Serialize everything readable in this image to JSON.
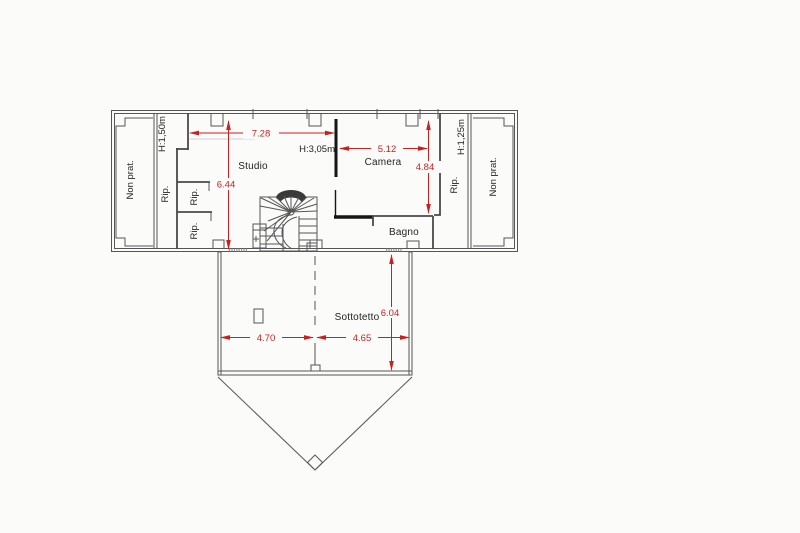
{
  "canvas": {
    "background": "#fbfbfa",
    "wall_color": "#565656",
    "dark_wall_color": "#161616",
    "dimension_color": "#cd1e1e",
    "text_color": "#232323"
  },
  "floor_plan": {
    "rooms": {
      "non_prat_left": {
        "label": "Non prat."
      },
      "storage_strip_left": {
        "label": "Rip.",
        "height_label": "H:1,50m"
      },
      "storage_upper": {
        "label": "Rip."
      },
      "storage_lower": {
        "label": "Rip."
      },
      "studio": {
        "label": "Studio",
        "width": "7.28",
        "depth": "6.44"
      },
      "camera": {
        "label": "Camera",
        "height_label": "H:3,05m",
        "width": "5.12",
        "depth": "4.84"
      },
      "bagno": {
        "label": "Bagno"
      },
      "storage_strip_right": {
        "label": "Rip.",
        "height_label": "H:1,25m"
      },
      "non_prat_right": {
        "label": "Non prat."
      },
      "sottotetto": {
        "label": "Sottotetto",
        "depth": "6.04",
        "width_left": "4.70",
        "width_right": "4.65"
      }
    }
  }
}
